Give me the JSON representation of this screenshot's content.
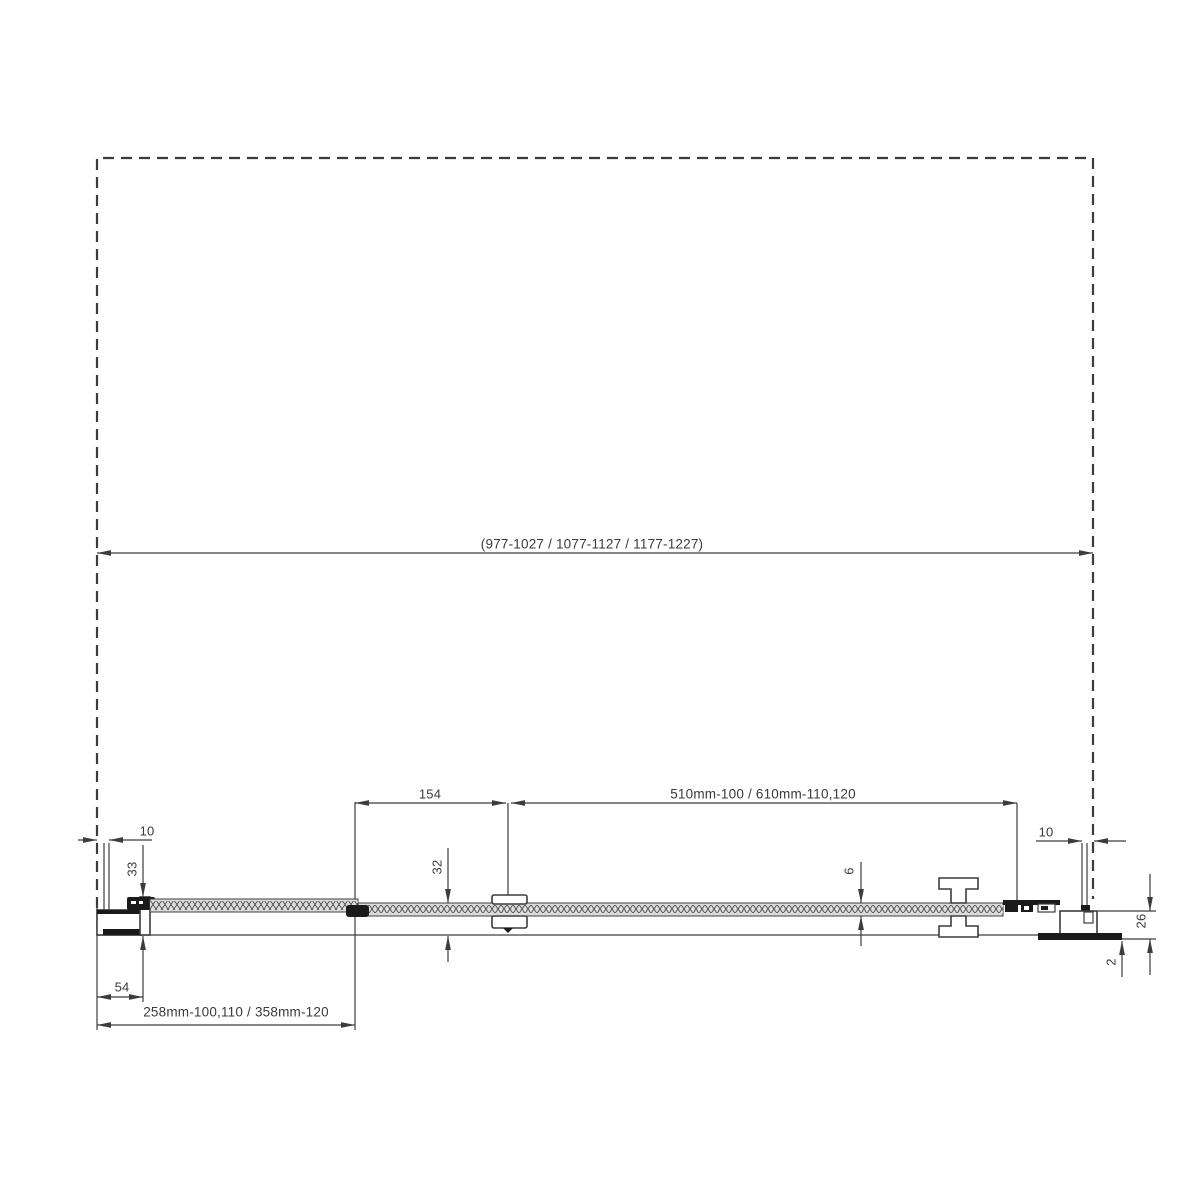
{
  "dims": {
    "overall_width": "(977-1027 / 1077-1127 / 1177-1227)",
    "door_glass_width": "510mm-100 / 610mm-110,120",
    "panel_joint_offset": "154",
    "fixed_panel_width": "258mm-100,110 / 358mm-120",
    "wall_profile_depth": "54",
    "wall_gap_left": "10",
    "wall_gap_right": "10",
    "profile_height_left": "33",
    "profile_height_mid": "32",
    "glass_thickness": "6",
    "bottom_profile_height": "26",
    "tray_edge_thickness": "2"
  },
  "colors": {
    "background": "#ffffff",
    "line": "#3c3c3c",
    "dark_fill": "#1a1a1a",
    "glass_fill": "#dcdcdc",
    "text": "#3a3a3a"
  }
}
